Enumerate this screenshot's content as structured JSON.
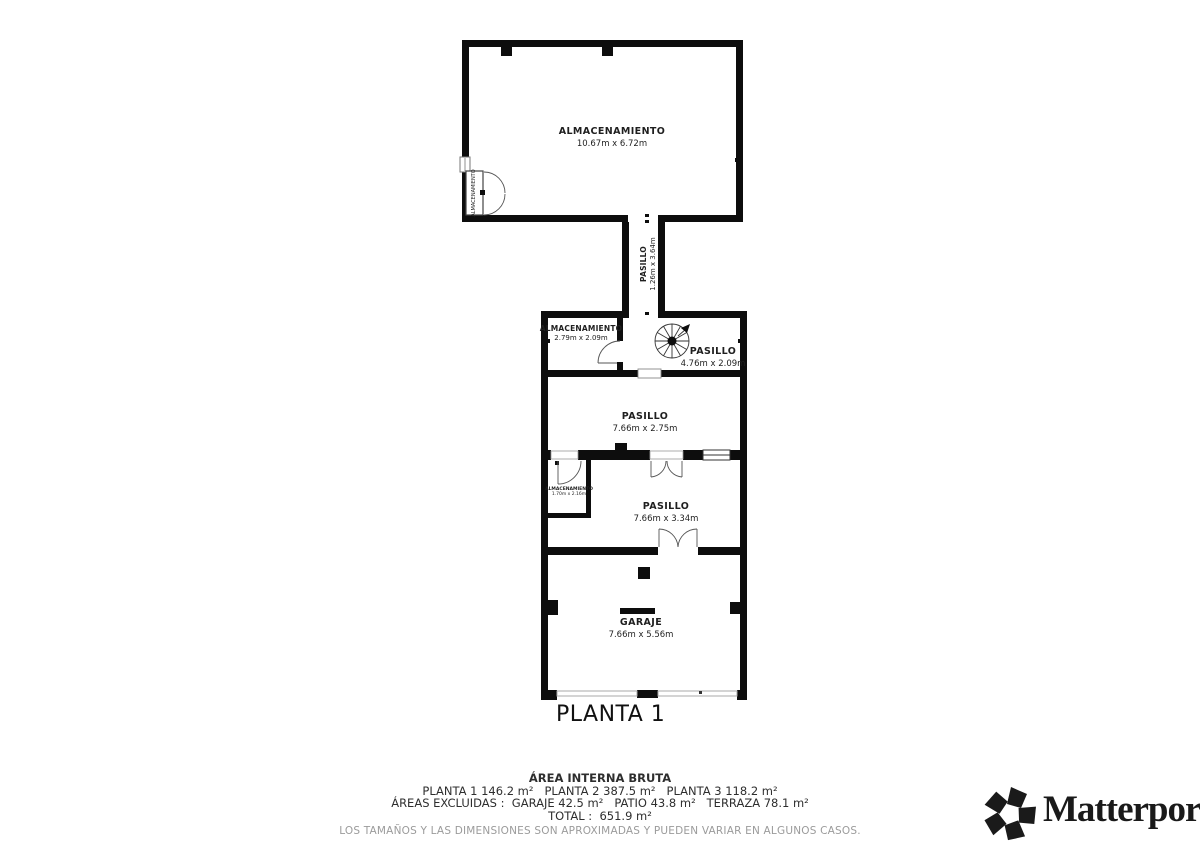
{
  "plan": {
    "floor_label": "PLANTA 1",
    "rooms": {
      "storage_top": {
        "name": "ALMACENAMIENTO",
        "dims": "10.67m x 6.72m"
      },
      "closet_top": {
        "name": "ALMACENAMIENTO"
      },
      "corridor": {
        "name": "PASILLO",
        "dims": "1.26m x 3.64m"
      },
      "storage_mid": {
        "name": "ALMACENAMIENTO",
        "dims": "2.79m x 2.09m"
      },
      "hall_stairs": {
        "name": "PASILLO",
        "dims": "4.76m x 2.09m"
      },
      "hall_upper": {
        "name": "PASILLO",
        "dims": "7.66m x 2.75m"
      },
      "storage_small": {
        "name": "ALMACENAMIENTO",
        "dims": "1.70m x 2.16m"
      },
      "hall_lower": {
        "name": "PASILLO",
        "dims": "7.66m x 3.34m"
      },
      "garage": {
        "name": "GARAJE",
        "dims": "7.66m x 5.56m"
      }
    }
  },
  "summary": {
    "title": "ÁREA INTERNA BRUTA",
    "plantas": "PLANTA 1 146.2 m²   PLANTA 2 387.5 m²   PLANTA 3 118.2 m²",
    "excluidas": "ÁREAS EXCLUIDAS :  GARAJE 42.5 m²   PATIO 43.8 m²   TERRAZA 78.1 m²",
    "total": "TOTAL :  651.9 m²",
    "disclaimer": "LOS TAMAÑOS Y LAS DIMENSIONES SON APROXIMADAS Y PUEDEN VARIAR EN ALGUNOS CASOS."
  },
  "branding": {
    "name": "Matterport",
    "registered": "®"
  },
  "colors": {
    "wall": "#0d0d0d",
    "text_dark": "#2e2e2e",
    "text_gray": "#9b9b9b",
    "background": "#ffffff"
  }
}
